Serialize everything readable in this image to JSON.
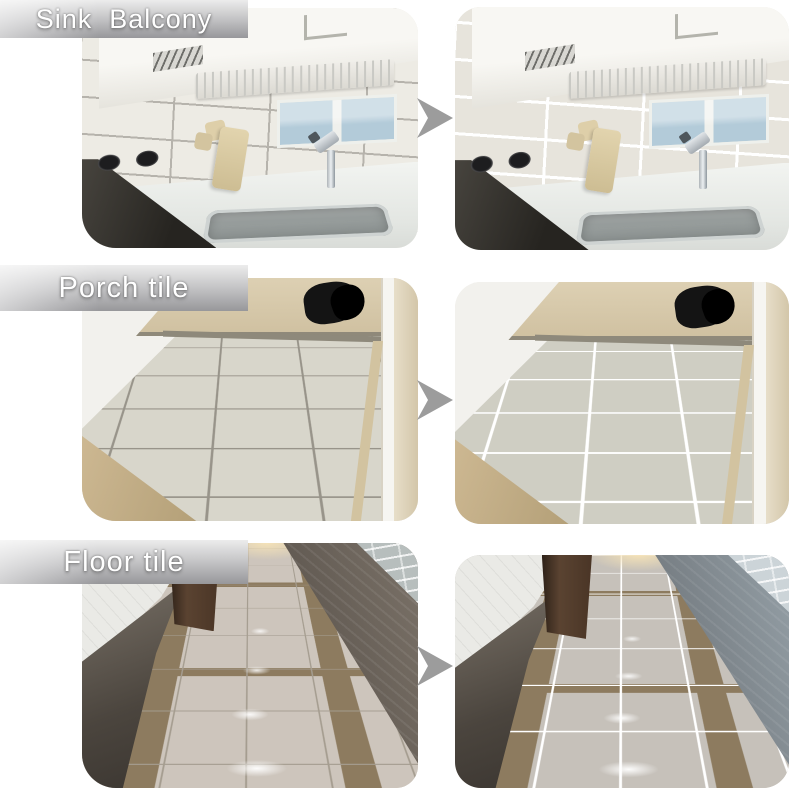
{
  "product_demo": {
    "rows": [
      {
        "label": "Sink  Balcony",
        "scene": "kitchen-sink-wall"
      },
      {
        "label": "Porch tile",
        "scene": "porch-floor-tile"
      },
      {
        "label": "Floor tile",
        "scene": "hallway-floor-tile"
      }
    ],
    "icons": {
      "between_photos": "right-arrow"
    },
    "colors": {
      "page_background": "#ffffff",
      "banner_text": "#ffffff",
      "banner_top": "#ececec",
      "banner_bottom": "#97979a",
      "arrow": "#9c9c9c",
      "grout_before": "#a09c90",
      "grout_after": "#ffffff"
    }
  }
}
